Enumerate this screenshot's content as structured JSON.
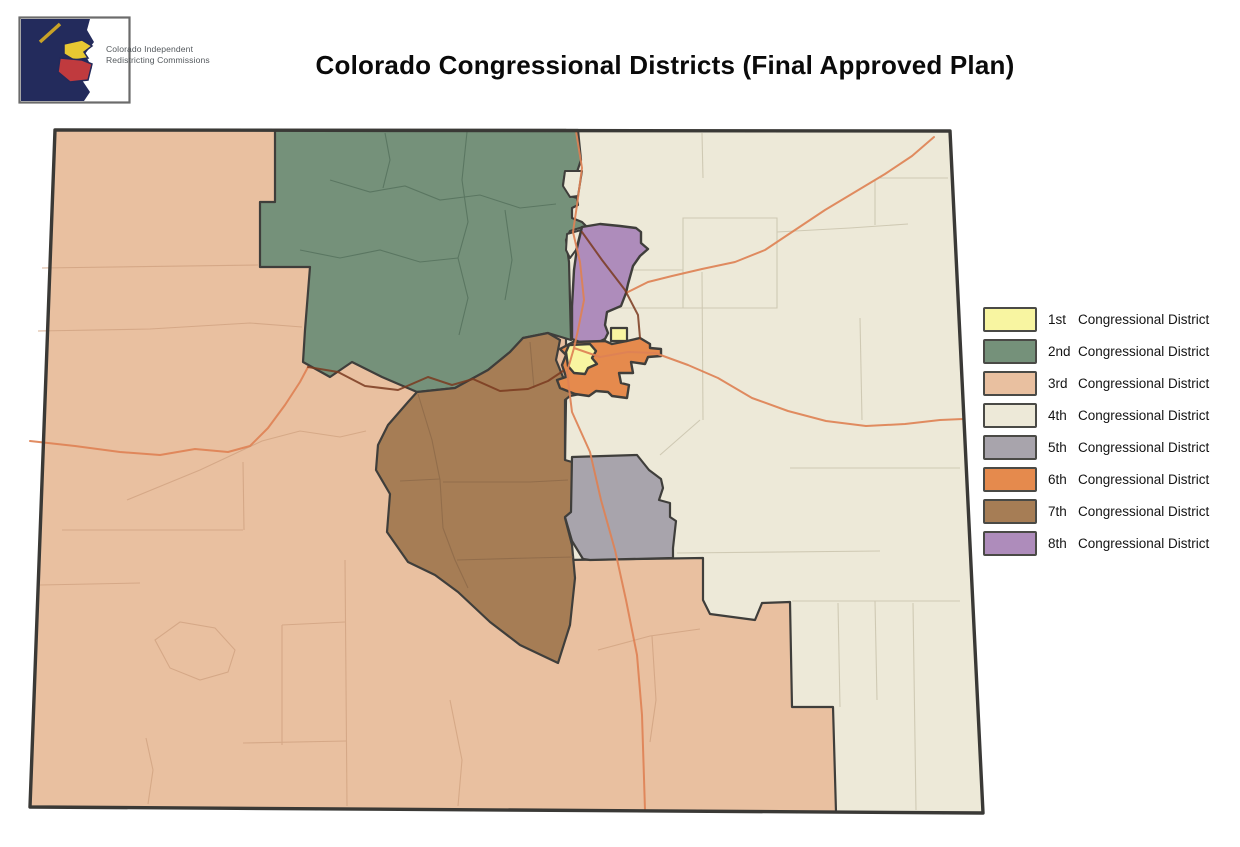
{
  "header": {
    "logo_text_line1": "Colorado Independent",
    "logo_text_line2": "Redistricting Commissions",
    "title": "Colorado Congressional Districts (Final Approved Plan)"
  },
  "legend": {
    "items": [
      {
        "ordinal": "1st",
        "label": "Congressional District"
      },
      {
        "ordinal": "2nd",
        "label": "Congressional District"
      },
      {
        "ordinal": "3rd",
        "label": "Congressional District"
      },
      {
        "ordinal": "4th",
        "label": "Congressional District"
      },
      {
        "ordinal": "5th",
        "label": "Congressional District"
      },
      {
        "ordinal": "6th",
        "label": "Congressional District"
      },
      {
        "ordinal": "7th",
        "label": "Congressional District"
      },
      {
        "ordinal": "8th",
        "label": "Congressional District"
      }
    ]
  },
  "map": {
    "districts": [
      {
        "id": 1,
        "name": "1st Congressional District",
        "color": "#F8F5A1"
      },
      {
        "id": 2,
        "name": "2nd Congressional District",
        "color": "#75917A"
      },
      {
        "id": 3,
        "name": "3rd Congressional District",
        "color": "#E9C0A0"
      },
      {
        "id": 4,
        "name": "4th Congressional District",
        "color": "#EDE9D8"
      },
      {
        "id": 5,
        "name": "5th Congressional District",
        "color": "#A8A4AC"
      },
      {
        "id": 6,
        "name": "6th Congressional District",
        "color": "#E58A4D"
      },
      {
        "id": 7,
        "name": "7th Congressional District",
        "color": "#A67D55"
      },
      {
        "id": 8,
        "name": "8th Congressional District",
        "color": "#AE8CBB"
      }
    ],
    "state_border_color": "#3a3936",
    "district_border_color": "#3f3e3b",
    "highway_color": "#DE8255",
    "mountain_highway_color": "#7A3A20",
    "logo_navy": "#232B5C",
    "logo_yellow": "#E8C832",
    "logo_red": "#C03A3E"
  }
}
